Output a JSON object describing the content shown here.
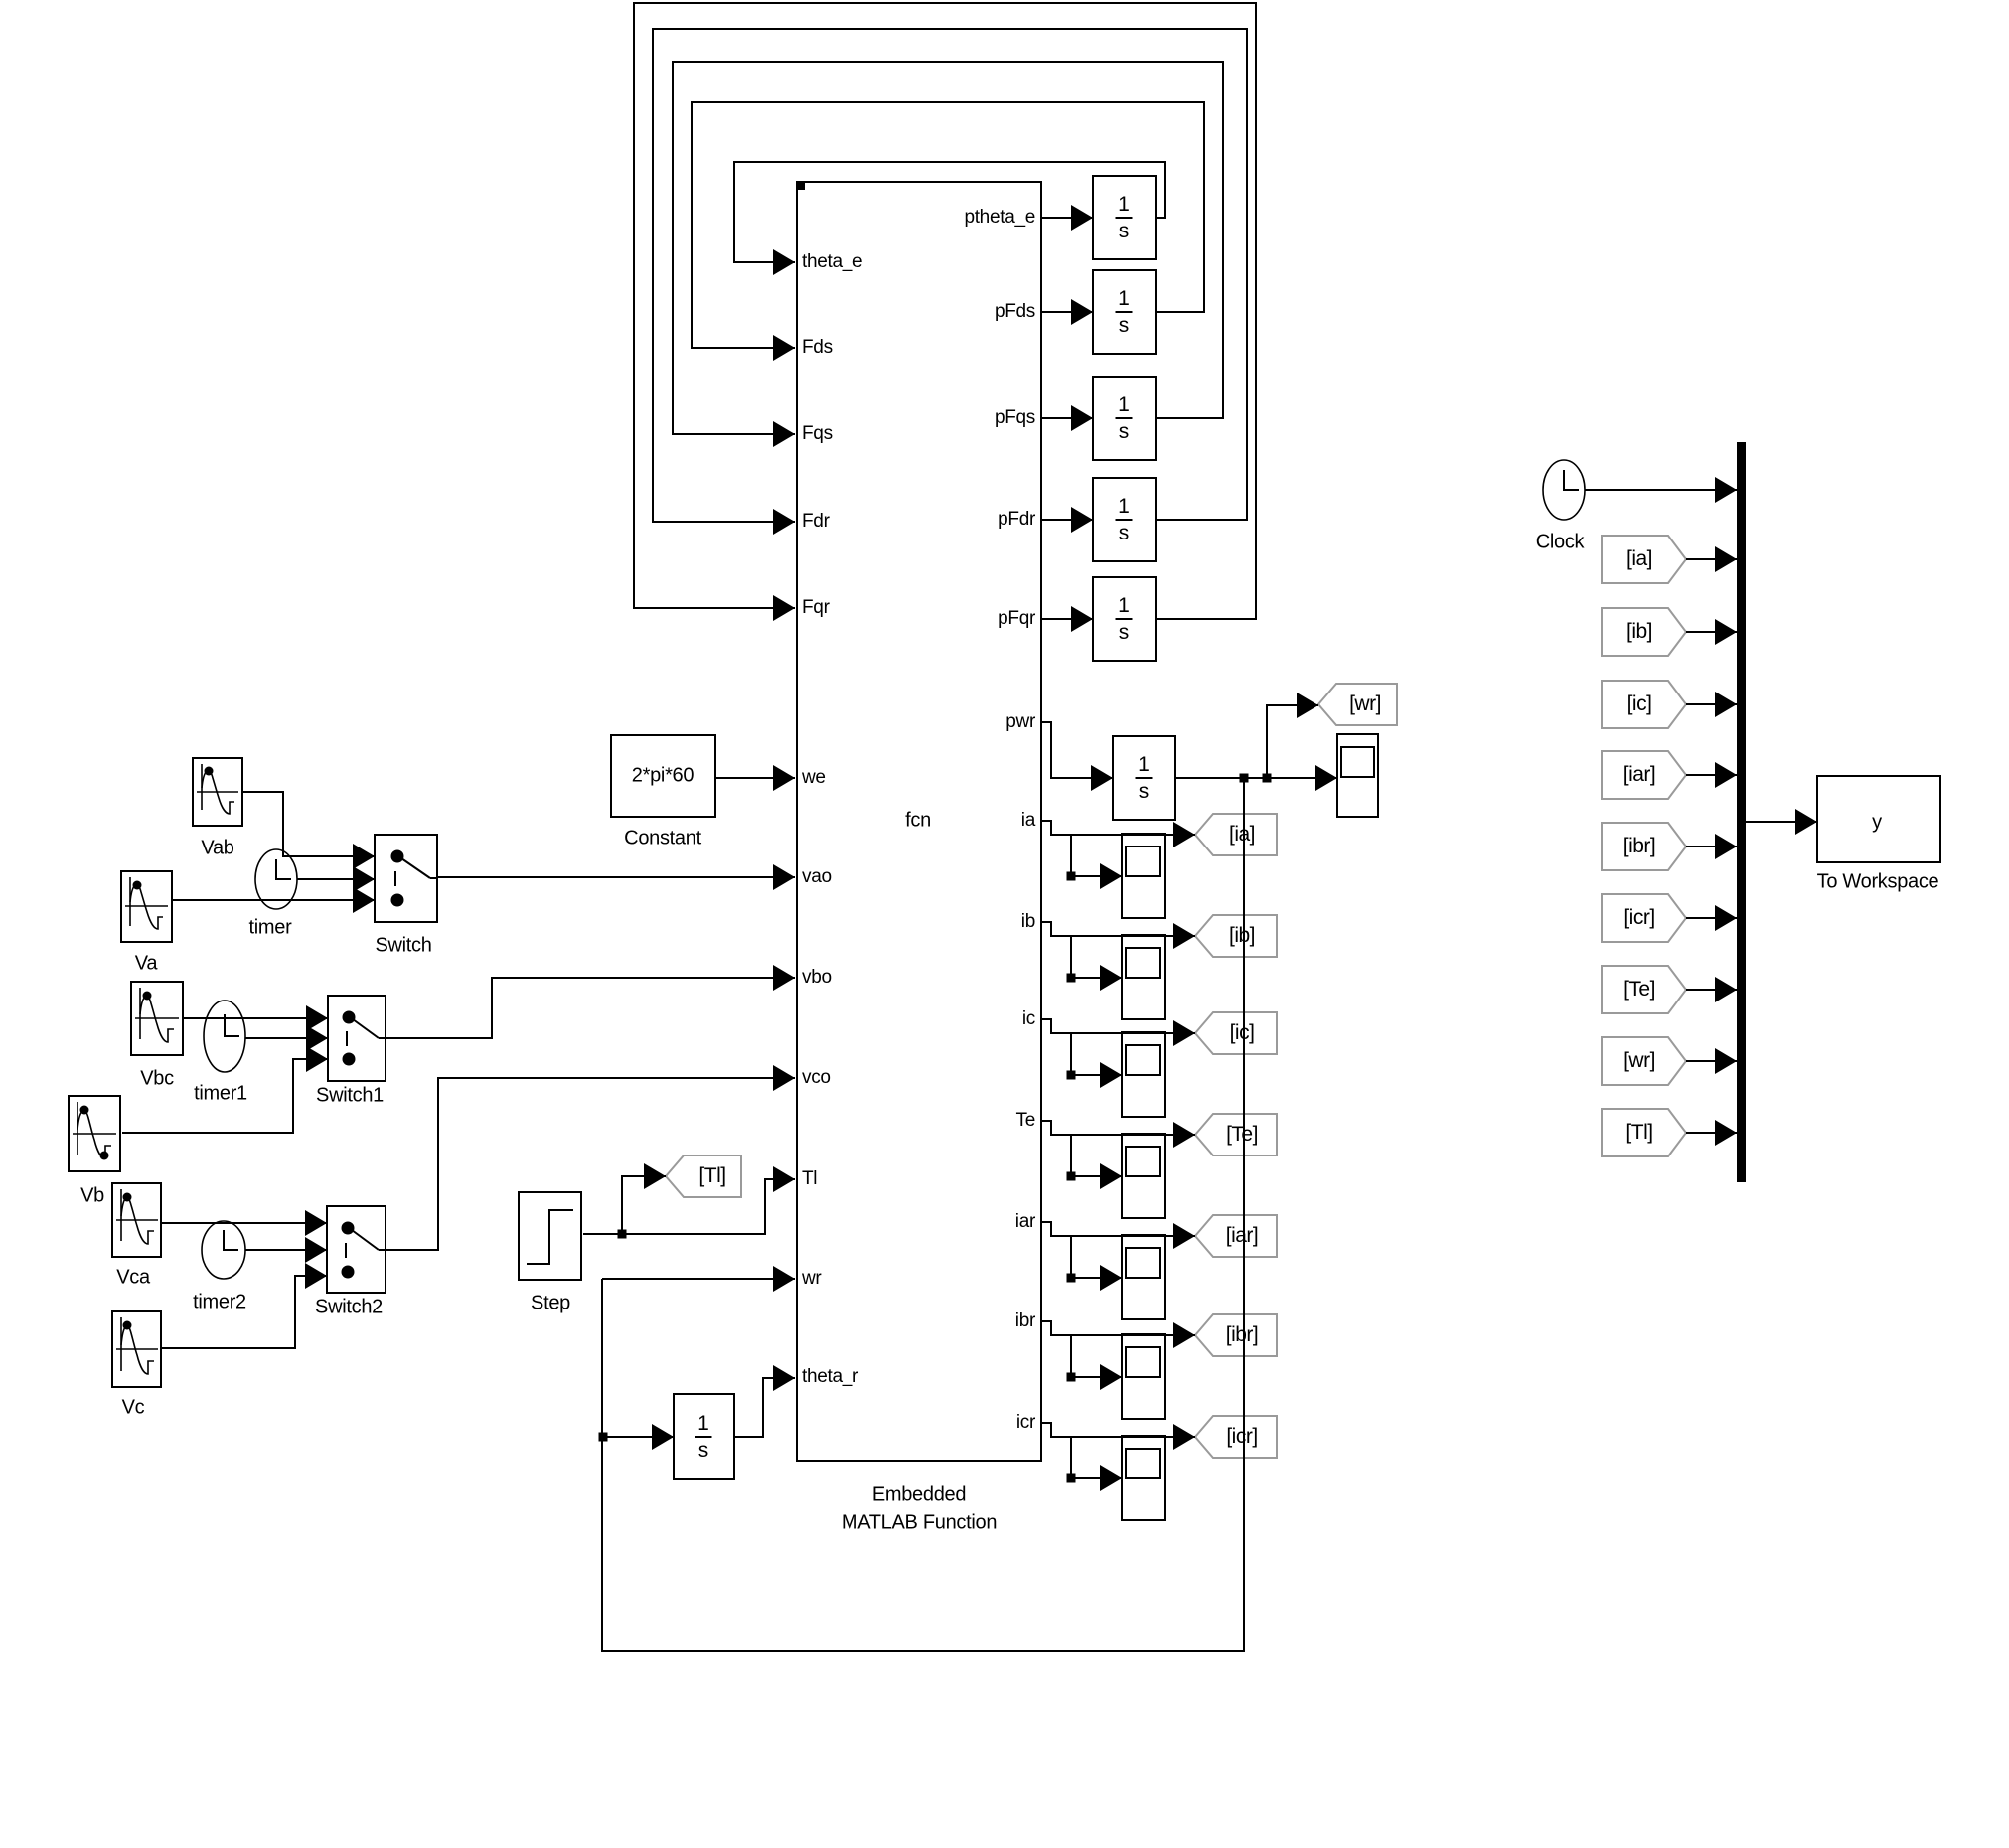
{
  "function_block": {
    "label": "fcn",
    "caption_line1": "Embedded",
    "caption_line2": "MATLAB Function",
    "input_ports": [
      "theta_e",
      "Fds",
      "Fqs",
      "Fdr",
      "Fqr",
      "we",
      "vao",
      "vbo",
      "vco",
      "Tl",
      "wr",
      "theta_r"
    ],
    "output_ports": [
      "ptheta_e",
      "pFds",
      "pFqs",
      "pFdr",
      "pFqr",
      "pwr",
      "ia",
      "ib",
      "ic",
      "Te",
      "iar",
      "ibr",
      "icr"
    ]
  },
  "integrator": {
    "numerator": "1",
    "denominator": "s"
  },
  "constant": {
    "value": "2*pi*60",
    "label": "Constant"
  },
  "step": {
    "label": "Step"
  },
  "sources": {
    "vab": "Vab",
    "va": "Va",
    "vbc": "Vbc",
    "vb": "Vb",
    "vca": "Vca",
    "vc": "Vc"
  },
  "timers": {
    "timer": "timer",
    "timer1": "timer1",
    "timer2": "timer2"
  },
  "switches": {
    "switch": "Switch",
    "switch1": "Switch1",
    "switch2": "Switch2"
  },
  "clock": {
    "label": "Clock"
  },
  "goto_tags": {
    "tl": "[Tl]",
    "wr": "[wr]",
    "ia": "[ia]",
    "ib": "[ib]",
    "ic": "[ic]",
    "te": "[Te]",
    "iar": "[iar]",
    "ibr": "[ibr]",
    "icr": "[icr]"
  },
  "from_tags": [
    "[ia]",
    "[ib]",
    "[ic]",
    "[iar]",
    "[ibr]",
    "[icr]",
    "[Te]",
    "[wr]",
    "[Tl]"
  ],
  "to_workspace": {
    "variable": "y",
    "label": "To Workspace"
  }
}
